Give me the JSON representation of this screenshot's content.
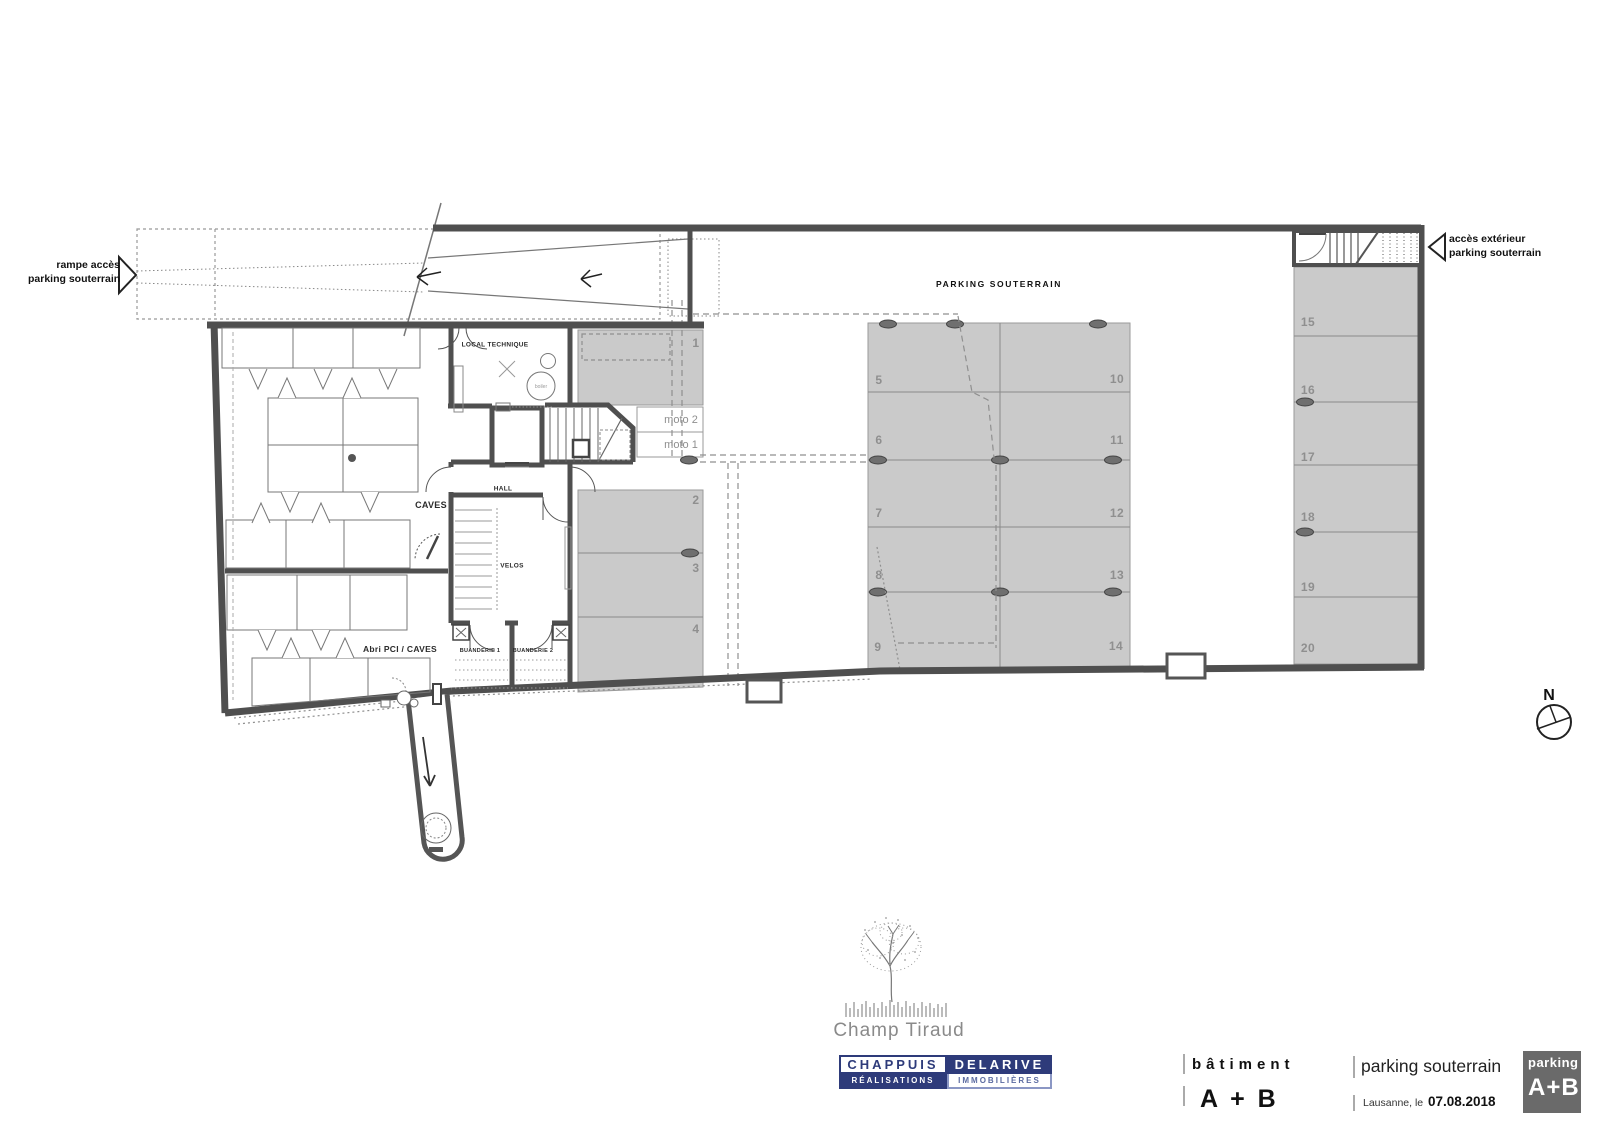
{
  "drawing": {
    "title": "PARKING SOUTERRAIN",
    "ramp_label": {
      "line1": "rampe accès",
      "line2": "parking souterrain"
    },
    "exterior_access_label": {
      "line1": "accès extérieur",
      "line2": "parking souterrain"
    },
    "north_label": "N"
  },
  "rooms": {
    "local_technique": "LOCAL TECHNIQUE",
    "boiler": "boiler",
    "caves": "CAVES",
    "hall": "HALL",
    "velos": "VELOS",
    "buanderie_1": "BUANDERIE 1",
    "buanderie_2": "BUANDERIE 2",
    "abri_pci": "Abri PCI / CAVES"
  },
  "spots": {
    "s1": "1",
    "s2": "2",
    "s3": "3",
    "s4": "4",
    "s5": "5",
    "s6": "6",
    "s7": "7",
    "s8": "8",
    "s9": "9",
    "s10": "10",
    "s11": "11",
    "s12": "12",
    "s13": "13",
    "s14": "14",
    "s15": "15",
    "s16": "16",
    "s17": "17",
    "s18": "18",
    "s19": "19",
    "s20": "20",
    "moto1": "moto 1",
    "moto2": "moto 2"
  },
  "footer": {
    "project_name": "Champ Tiraud",
    "brand": {
      "chappuis": "CHAPPUIS",
      "delarive": "DELARIVE",
      "realisations": "RÉALISATIONS",
      "immobilieres": "IMMOBILIÈRES"
    }
  },
  "titleblock": {
    "building_label": "bâtiment",
    "building_value": "A + B",
    "sheet_title": "parking souterrain",
    "place_label": "Lausanne, le",
    "date": "07.08.2018",
    "stamp": {
      "top": "parking",
      "bottom": "A+B"
    }
  },
  "colors": {
    "brand_navy": "#2e3b7a",
    "stamp_gray": "#6a6a6a",
    "parking_fill": "#cacaca",
    "wall": "#4f4f4f",
    "number_gray": "#8f8f8f"
  }
}
